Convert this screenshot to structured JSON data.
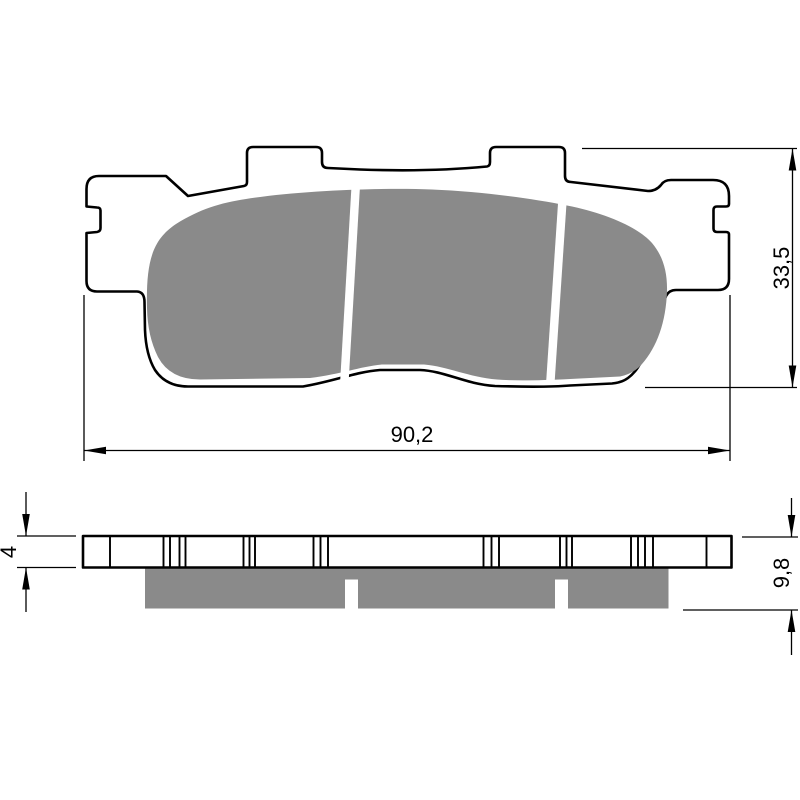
{
  "colors": {
    "background": "#ffffff",
    "line": "#000000",
    "friction": "#8a8a8a",
    "groove": "#ffffff"
  },
  "dimensions": {
    "width": {
      "value": "90,2"
    },
    "height": {
      "value": "33,5"
    },
    "backplate_thickness": {
      "value": "4"
    },
    "overall_thickness": {
      "value": "9,8"
    }
  }
}
